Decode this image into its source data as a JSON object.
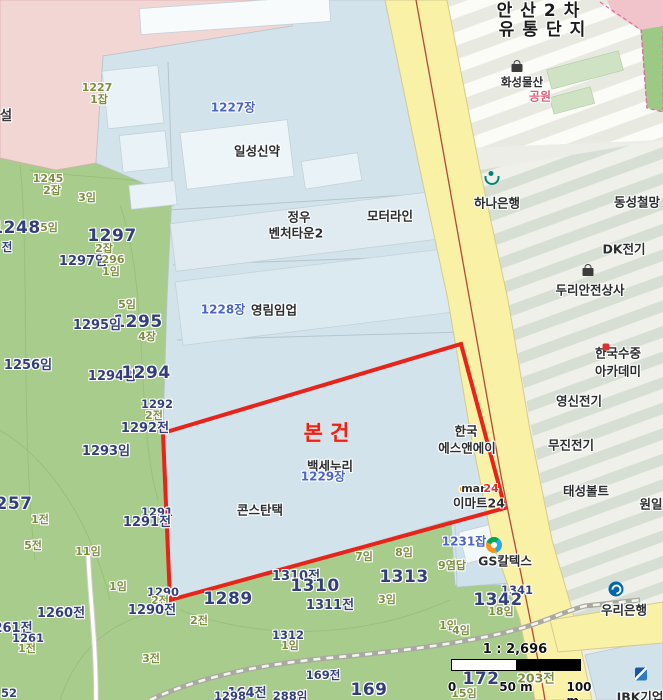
{
  "map": {
    "colors": {
      "subject_red": "#e8231a",
      "lot_navy": "#333f7d",
      "land_olive": "#7d8f3f",
      "parcel_label_blue": "#4a64c8",
      "forest_green": "#a7cc8c",
      "parcel_blue": "#d3e3ec",
      "road_yellow": "#f8f1a6",
      "park_pink": "#e0607a",
      "emart_orange": "#f59a1e",
      "emart_red": "#e0301e"
    },
    "scale": {
      "ratio_text": "1 : 2,696",
      "ticks": [
        "0",
        "50 m",
        "100 m"
      ]
    },
    "labels": [
      {
        "n": "district-title-line1",
        "t": "안산2차",
        "x": 542,
        "y": 12,
        "c": "poiBig"
      },
      {
        "n": "district-title-line2",
        "t": "유통단지",
        "x": 546,
        "y": 31,
        "c": "poiBig"
      },
      {
        "n": "poi-hwaseong-mulsan",
        "t": "화성물산",
        "x": 522,
        "y": 82,
        "c": "poiSm"
      },
      {
        "n": "poi-park",
        "t": "공원",
        "x": 540,
        "y": 97,
        "c": "park"
      },
      {
        "n": "label-seol",
        "t": "설",
        "x": 6,
        "y": 116,
        "c": "poiMed"
      },
      {
        "n": "lot-1227",
        "t": "1227",
        "x": 97,
        "y": 88,
        "c": "suffix"
      },
      {
        "n": "lot-1227-1jap",
        "t": "1잡",
        "x": 99,
        "y": 100,
        "c": "suffix"
      },
      {
        "n": "lot-1227jang",
        "t": "1227장",
        "x": 233,
        "y": 108,
        "c": "blueLot"
      },
      {
        "n": "poi-ilseong-sinyak",
        "t": "일성신약",
        "x": 257,
        "y": 151,
        "c": "poi"
      },
      {
        "n": "lot-1245",
        "t": "1245",
        "x": 48,
        "y": 179,
        "c": "suffix"
      },
      {
        "n": "lot-1245-2jap",
        "t": "2잡",
        "x": 52,
        "y": 191,
        "c": "suffix"
      },
      {
        "n": "lot-3im",
        "t": "3임",
        "x": 87,
        "y": 198,
        "c": "suffix"
      },
      {
        "n": "poi-jungwoo-line1",
        "t": "정우",
        "x": 299,
        "y": 217,
        "c": "poi"
      },
      {
        "n": "poi-jungwoo-line2",
        "t": "벤처타운2",
        "x": 296,
        "y": 233,
        "c": "poi"
      },
      {
        "n": "poi-motorline",
        "t": "모터라인",
        "x": 390,
        "y": 216,
        "c": "poi"
      },
      {
        "n": "lot-1248",
        "t": "1248",
        "x": 16,
        "y": 229,
        "c": "lotBig"
      },
      {
        "n": "lot-5im-a",
        "t": "5임",
        "x": 49,
        "y": 228,
        "c": "suffix"
      },
      {
        "n": "lot-jeon-a",
        "t": "전",
        "x": 7,
        "y": 247,
        "c": "lotSm"
      },
      {
        "n": "lot-1297",
        "t": "1297",
        "x": 112,
        "y": 237,
        "c": "lotBig"
      },
      {
        "n": "lot-2jap-b",
        "t": "2잡",
        "x": 104,
        "y": 249,
        "c": "suffix"
      },
      {
        "n": "lot-1297im",
        "t": "1297임",
        "x": 83,
        "y": 262,
        "c": "lotMed"
      },
      {
        "n": "lot-296",
        "t": "296",
        "x": 113,
        "y": 260,
        "c": "suffix"
      },
      {
        "n": "lot-1im-a",
        "t": "1임",
        "x": 111,
        "y": 272,
        "c": "suffix"
      },
      {
        "n": "lot-5im-b",
        "t": "5임",
        "x": 127,
        "y": 305,
        "c": "suffix"
      },
      {
        "n": "lot-1228jang",
        "t": "1228장",
        "x": 223,
        "y": 310,
        "c": "blueLot"
      },
      {
        "n": "poi-yonglim",
        "t": "영림임업",
        "x": 274,
        "y": 310,
        "c": "poi"
      },
      {
        "n": "lot-1295",
        "t": "1295",
        "x": 138,
        "y": 323,
        "c": "lotBig"
      },
      {
        "n": "lot-1295im",
        "t": "1295임",
        "x": 97,
        "y": 326,
        "c": "lotMed"
      },
      {
        "n": "lot-4jang",
        "t": "4장",
        "x": 147,
        "y": 337,
        "c": "suffix"
      },
      {
        "n": "lot-1256im",
        "t": "1256임",
        "x": 28,
        "y": 366,
        "c": "lotMed"
      },
      {
        "n": "lot-1294im",
        "t": "1294임",
        "x": 112,
        "y": 377,
        "c": "lotMed"
      },
      {
        "n": "lot-1294",
        "t": "1294",
        "x": 146,
        "y": 374,
        "c": "lotBig"
      },
      {
        "n": "lot-1292",
        "t": "1292",
        "x": 157,
        "y": 404,
        "c": "lotSm"
      },
      {
        "n": "lot-2jeon-a",
        "t": "2전",
        "x": 154,
        "y": 416,
        "c": "suffix"
      },
      {
        "n": "lot-1292jeon",
        "t": "1292전",
        "x": 145,
        "y": 429,
        "c": "lotMed"
      },
      {
        "n": "lot-1293im",
        "t": "1293임",
        "x": 106,
        "y": 452,
        "c": "lotMed"
      },
      {
        "n": "lot-257",
        "t": "257",
        "x": 14,
        "y": 505,
        "c": "lotBig"
      },
      {
        "n": "lot-1jeon-a",
        "t": "1전",
        "x": 40,
        "y": 520,
        "c": "suffix"
      },
      {
        "n": "lot-1291",
        "t": "1291",
        "x": 157,
        "y": 512,
        "c": "lotSm"
      },
      {
        "n": "lot-1291jeon",
        "t": "1291전",
        "x": 147,
        "y": 523,
        "c": "lotMed"
      },
      {
        "n": "lot-5jeon",
        "t": "5전",
        "x": 33,
        "y": 546,
        "c": "suffix"
      },
      {
        "n": "lot-11im",
        "t": "11임",
        "x": 88,
        "y": 552,
        "c": "suffix"
      },
      {
        "n": "lot-1im-b",
        "t": "1임",
        "x": 118,
        "y": 587,
        "c": "suffix"
      },
      {
        "n": "lot-1290",
        "t": "1290",
        "x": 163,
        "y": 592,
        "c": "lotSm"
      },
      {
        "n": "lot-2jeon-b",
        "t": "2전",
        "x": 160,
        "y": 601,
        "c": "suffix"
      },
      {
        "n": "lot-1290jeon",
        "t": "1290전",
        "x": 152,
        "y": 611,
        "c": "lotMed"
      },
      {
        "n": "lot-1260jeon",
        "t": "1260전",
        "x": 61,
        "y": 614,
        "c": "lotMed"
      },
      {
        "n": "lot-261jeon",
        "t": "261전",
        "x": 13,
        "y": 629,
        "c": "lotMed"
      },
      {
        "n": "lot-1261",
        "t": "1261",
        "x": 28,
        "y": 638,
        "c": "lotSm"
      },
      {
        "n": "lot-1jeon-b",
        "t": "1전",
        "x": 27,
        "y": 649,
        "c": "suffix"
      },
      {
        "n": "lot-1289",
        "t": "1289",
        "x": 228,
        "y": 600,
        "c": "lotBig"
      },
      {
        "n": "lot-2jeon-c",
        "t": "2전",
        "x": 199,
        "y": 621,
        "c": "suffix"
      },
      {
        "n": "lot-3jeon",
        "t": "3전",
        "x": 151,
        "y": 659,
        "c": "suffix"
      },
      {
        "n": "subject-parcel-label",
        "t": "본건",
        "x": 330,
        "y": 433,
        "c": "subject"
      },
      {
        "n": "poi-baekse-nuri",
        "t": "백세누리",
        "x": 330,
        "y": 466,
        "c": "poi"
      },
      {
        "n": "lot-1229jang",
        "t": "1229장",
        "x": 323,
        "y": 477,
        "c": "blueLot"
      },
      {
        "n": "poi-constantech",
        "t": "콘스탄택",
        "x": 260,
        "y": 510,
        "c": "poi"
      },
      {
        "n": "poi-hanguk-sna-line1",
        "t": "한국",
        "x": 466,
        "y": 431,
        "c": "poi"
      },
      {
        "n": "poi-hanguk-sna-line2",
        "t": "에스앤에이",
        "x": 467,
        "y": 448,
        "c": "poi"
      },
      {
        "n": "emart-logo-e",
        "t": "e",
        "x": 463,
        "y": 489,
        "c": "emartE"
      },
      {
        "n": "emart-logo-mart",
        "t": "mart",
        "x": 476,
        "y": 489,
        "c": "emartM"
      },
      {
        "n": "emart-logo-24",
        "t": "24",
        "x": 491,
        "y": 489,
        "c": "emart24"
      },
      {
        "n": "poi-emart24",
        "t": "이마트24",
        "x": 479,
        "y": 503,
        "c": "poi"
      },
      {
        "n": "lot-1231jap",
        "t": "1231잡",
        "x": 464,
        "y": 542,
        "c": "blueLot"
      },
      {
        "n": "poi-gs-caltex",
        "t": "GS칼텍스",
        "x": 505,
        "y": 561,
        "c": "poi"
      },
      {
        "n": "lot-9yeomdap",
        "t": "9염답",
        "x": 452,
        "y": 566,
        "c": "suffix"
      },
      {
        "n": "poi-hana-bank",
        "t": "하나은행",
        "x": 497,
        "y": 203,
        "c": "poi"
      },
      {
        "n": "poi-dongseong",
        "t": "동성철망",
        "x": 637,
        "y": 202,
        "c": "poi"
      },
      {
        "n": "poi-dk-electric",
        "t": "DK전기",
        "x": 624,
        "y": 249,
        "c": "poi"
      },
      {
        "n": "poi-duri-safety",
        "t": "두리안전상사",
        "x": 590,
        "y": 290,
        "c": "poi"
      },
      {
        "n": "poi-sujung-line1",
        "t": "한국수중",
        "x": 618,
        "y": 353,
        "c": "poi"
      },
      {
        "n": "poi-sujung-line2",
        "t": "아카데미",
        "x": 618,
        "y": 371,
        "c": "poi"
      },
      {
        "n": "poi-yeongshin",
        "t": "영신전기",
        "x": 579,
        "y": 401,
        "c": "poi"
      },
      {
        "n": "poi-mujin",
        "t": "무진전기",
        "x": 571,
        "y": 445,
        "c": "poi"
      },
      {
        "n": "poi-taeseong-bolt",
        "t": "태성볼트",
        "x": 586,
        "y": 491,
        "c": "poi"
      },
      {
        "n": "poi-wonil",
        "t": "원일",
        "x": 651,
        "y": 504,
        "c": "poi"
      },
      {
        "n": "lot-7im",
        "t": "7임",
        "x": 364,
        "y": 557,
        "c": "suffix"
      },
      {
        "n": "lot-8im",
        "t": "8임",
        "x": 404,
        "y": 553,
        "c": "suffix"
      },
      {
        "n": "lot-1310jeon",
        "t": "1310전",
        "x": 296,
        "y": 577,
        "c": "lotMed"
      },
      {
        "n": "lot-1310",
        "t": "1310",
        "x": 315,
        "y": 587,
        "c": "lotBig"
      },
      {
        "n": "lot-1311jeon",
        "t": "1311전",
        "x": 330,
        "y": 606,
        "c": "lotMed"
      },
      {
        "n": "lot-1313",
        "t": "1313",
        "x": 404,
        "y": 578,
        "c": "lotBig"
      },
      {
        "n": "lot-3im-b",
        "t": "3임",
        "x": 387,
        "y": 600,
        "c": "suffix"
      },
      {
        "n": "lot-1312",
        "t": "1312",
        "x": 288,
        "y": 635,
        "c": "lotSm"
      },
      {
        "n": "lot-1im-c",
        "t": "1임",
        "x": 290,
        "y": 646,
        "c": "suffix"
      },
      {
        "n": "lot-1341",
        "t": "1341",
        "x": 517,
        "y": 590,
        "c": "lotSm"
      },
      {
        "n": "lot-1342",
        "t": "1342",
        "x": 498,
        "y": 601,
        "c": "lotBig"
      },
      {
        "n": "lot-18im",
        "t": "18임",
        "x": 501,
        "y": 612,
        "c": "suffix"
      },
      {
        "n": "lot-1im-d",
        "t": "1임",
        "x": 448,
        "y": 626,
        "c": "suffix"
      },
      {
        "n": "lot-4im",
        "t": "4임",
        "x": 461,
        "y": 631,
        "c": "suffix"
      },
      {
        "n": "lot-164jeon",
        "t": "164전",
        "x": 247,
        "y": 694,
        "c": "lotMed"
      },
      {
        "n": "lot-169jeon",
        "t": "169전",
        "x": 323,
        "y": 675,
        "c": "lotSm"
      },
      {
        "n": "lot-169",
        "t": "169",
        "x": 369,
        "y": 691,
        "c": "lotBig"
      },
      {
        "n": "lot-1298",
        "t": "1298",
        "x": 230,
        "y": 696,
        "c": "lotSm"
      },
      {
        "n": "lot-288im",
        "t": "288임",
        "x": 290,
        "y": 696,
        "c": "lotSm"
      },
      {
        "n": "lot-52",
        "t": "52",
        "x": 9,
        "y": 693,
        "c": "lotSm"
      },
      {
        "n": "lot-172",
        "t": "172",
        "x": 481,
        "y": 680,
        "c": "lotBig"
      },
      {
        "n": "lot-203jeon",
        "t": "203전",
        "x": 536,
        "y": 678,
        "c": "suffix13"
      },
      {
        "n": "lot-15im",
        "t": "15임",
        "x": 464,
        "y": 694,
        "c": "suffix"
      },
      {
        "n": "poi-woori-bank",
        "t": "우리은행",
        "x": 624,
        "y": 610,
        "c": "poi"
      },
      {
        "n": "poi-ibk-bank",
        "t": "IBK기업",
        "x": 640,
        "y": 697,
        "c": "poi"
      }
    ],
    "icons": [
      {
        "n": "hwaseong-shopping-bag-icon",
        "type": "bag",
        "x": 517,
        "y": 68
      },
      {
        "n": "hana-bank-logo-icon",
        "type": "hana",
        "x": 491,
        "y": 178
      },
      {
        "n": "duri-shopping-bag-icon",
        "type": "bag",
        "x": 588,
        "y": 272
      },
      {
        "n": "scuba-academy-icon",
        "type": "scuba",
        "x": 606,
        "y": 347
      },
      {
        "n": "gs-caltex-logo-icon",
        "type": "gs",
        "x": 494,
        "y": 545
      },
      {
        "n": "woori-bank-logo-icon",
        "type": "woori",
        "x": 616,
        "y": 589
      },
      {
        "n": "ibk-bank-logo-icon",
        "type": "ibk",
        "x": 641,
        "y": 674
      }
    ]
  }
}
